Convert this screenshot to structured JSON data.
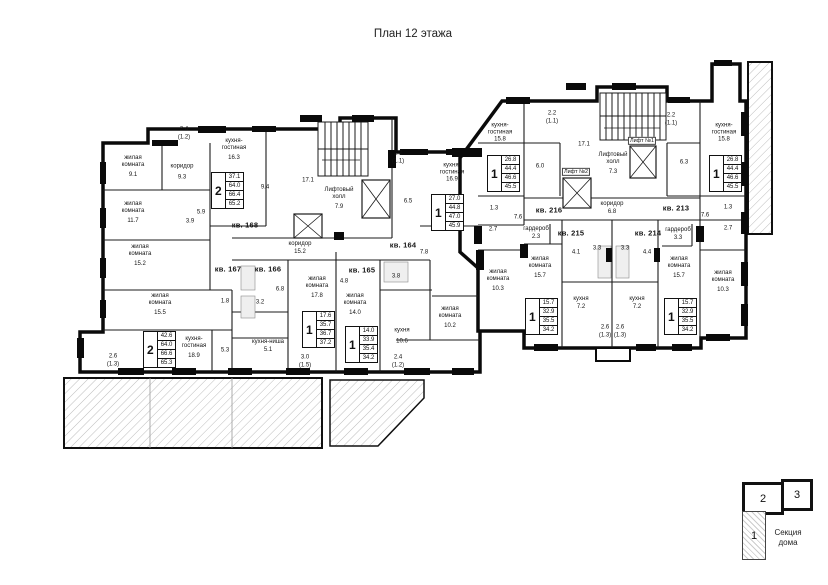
{
  "title": "План 12 этажа",
  "legend": {
    "caption_line1": "Секция",
    "caption_line2": "дома",
    "section1": "1",
    "section2": "2",
    "section3": "3"
  },
  "common_left": {
    "stairs_area": "17.1",
    "lift_hall_name": "Лифтовый холл",
    "lift_hall_area": "7.9",
    "corridor_name": "коридор",
    "corridor_area": "15.2"
  },
  "common_right": {
    "stairs_area": "17.1",
    "lift_hall_name": "Лифтовый холл",
    "lift_hall_area": "7.3",
    "lift1": "Лифт №1",
    "lift2": "Лифт №2",
    "corridor_name": "коридор",
    "corridor_area": "6.8"
  },
  "apartments": {
    "a168": {
      "number": "кв. 168",
      "type": "2",
      "stats": [
        "37.1",
        "64.0",
        "66.4",
        "65.2"
      ],
      "rooms": [
        {
          "n": "жилая комната",
          "a": "9.1"
        },
        {
          "n": "жилая комната",
          "a": "11.7"
        },
        {
          "n": "коридор",
          "a": "9.3"
        },
        {
          "n": "кухня-гостиная",
          "a": "16.3"
        },
        {
          "n": "",
          "a": "5.9"
        },
        {
          "n": "",
          "a": "3.9"
        },
        {
          "n": "",
          "a": "5.4"
        },
        {
          "n": "",
          "a": "9.4"
        }
      ],
      "balcony": "2.4",
      "balcony2": "(1.2)"
    },
    "a167": {
      "number": "кв. 167",
      "type": "2",
      "stats": [
        "42.6",
        "64.0",
        "66.6",
        "65.3"
      ],
      "rooms": [
        {
          "n": "жилая комната",
          "a": "15.2"
        },
        {
          "n": "жилая комната",
          "a": "15.5"
        },
        {
          "n": "кухня-гостиная",
          "a": "18.9"
        },
        {
          "n": "",
          "a": "5.3"
        },
        {
          "n": "",
          "a": "1.8"
        }
      ],
      "balcony": "2.6",
      "balcony2": "(1.3)"
    },
    "a166": {
      "number": "кв. 166",
      "type": "1",
      "stats": [
        "17.6",
        "35.7",
        "36.7",
        "37.2"
      ],
      "rooms": [
        {
          "n": "жилая комната",
          "a": "17.8"
        },
        {
          "n": "кухня-ниша",
          "a": "5.1"
        },
        {
          "n": "",
          "a": "3.2"
        },
        {
          "n": "",
          "a": "6.8"
        }
      ],
      "balcony": "3.0",
      "balcony2": "(1.5)"
    },
    "a165": {
      "number": "кв. 165",
      "type": "1",
      "stats": [
        "14.0",
        "33.9",
        "35.4",
        "34.2"
      ],
      "rooms": [
        {
          "n": "жилая комната",
          "a": "14.0"
        },
        {
          "n": "кухня",
          "a": "10.6"
        },
        {
          "n": "",
          "a": "4.8"
        },
        {
          "n": "",
          "a": "3.8"
        }
      ],
      "balcony": "2.4",
      "balcony2": "(1.2)"
    },
    "a164": {
      "number": "кв. 164",
      "type": "1",
      "stats": [
        "27.0",
        "44.8",
        "47.0",
        "45.9"
      ],
      "rooms": [
        {
          "n": "кухня-гостиная",
          "a": "16.9"
        },
        {
          "n": "жилая комната",
          "a": "10.2"
        },
        {
          "n": "",
          "a": "7.8"
        },
        {
          "n": "",
          "a": "6.5"
        }
      ],
      "balcony": "2.2",
      "balcony2": "(1.1)"
    },
    "a216": {
      "number": "кв. 216",
      "type": "1",
      "stats": [
        "26.8",
        "44.4",
        "46.6",
        "45.5"
      ],
      "rooms": [
        {
          "n": "кухня-гостиная",
          "a": "15.8"
        },
        {
          "n": "жилая комната",
          "a": "10.3"
        },
        {
          "n": "",
          "a": "6.0"
        },
        {
          "n": "",
          "a": "7.6"
        },
        {
          "n": "",
          "a": "1.3"
        },
        {
          "n": "",
          "a": "2.7"
        }
      ],
      "balcony": "2.2",
      "balcony2": "(1.1)"
    },
    "a215": {
      "number": "кв. 215",
      "type": "1",
      "stats": [
        "15.7",
        "32.9",
        "35.5",
        "34.2"
      ],
      "rooms": [
        {
          "n": "жилая комната",
          "a": "15.7"
        },
        {
          "n": "кухня",
          "a": "7.2"
        },
        {
          "n": "гардероб",
          "a": "2.3"
        },
        {
          "n": "",
          "a": "4.1"
        },
        {
          "n": "",
          "a": "3.3"
        }
      ],
      "balcony": "2.6",
      "balcony2": "(1.3)"
    },
    "a214": {
      "number": "кв. 214",
      "type": "1",
      "stats": [
        "15.7",
        "32.9",
        "35.5",
        "34.2"
      ],
      "rooms": [
        {
          "n": "жилая комната",
          "a": "15.7"
        },
        {
          "n": "кухня",
          "a": "7.2"
        },
        {
          "n": "",
          "a": "4.4"
        },
        {
          "n": "",
          "a": "3.3"
        }
      ],
      "balcony": "2.6",
      "balcony2": "(1.3)"
    },
    "a213": {
      "number": "кв. 213",
      "type": "1",
      "stats": [
        "26.8",
        "44.4",
        "46.6",
        "45.5"
      ],
      "rooms": [
        {
          "n": "кухня-гостиная",
          "a": "15.8"
        },
        {
          "n": "жилая комната",
          "a": "10.3"
        },
        {
          "n": "гардероб",
          "a": "3.3"
        },
        {
          "n": "",
          "a": "6.3"
        },
        {
          "n": "",
          "a": "7.6"
        },
        {
          "n": "",
          "a": "1.3"
        },
        {
          "n": "",
          "a": "2.7"
        }
      ],
      "balcony": "2.2",
      "balcony2": "(1.1)"
    }
  }
}
